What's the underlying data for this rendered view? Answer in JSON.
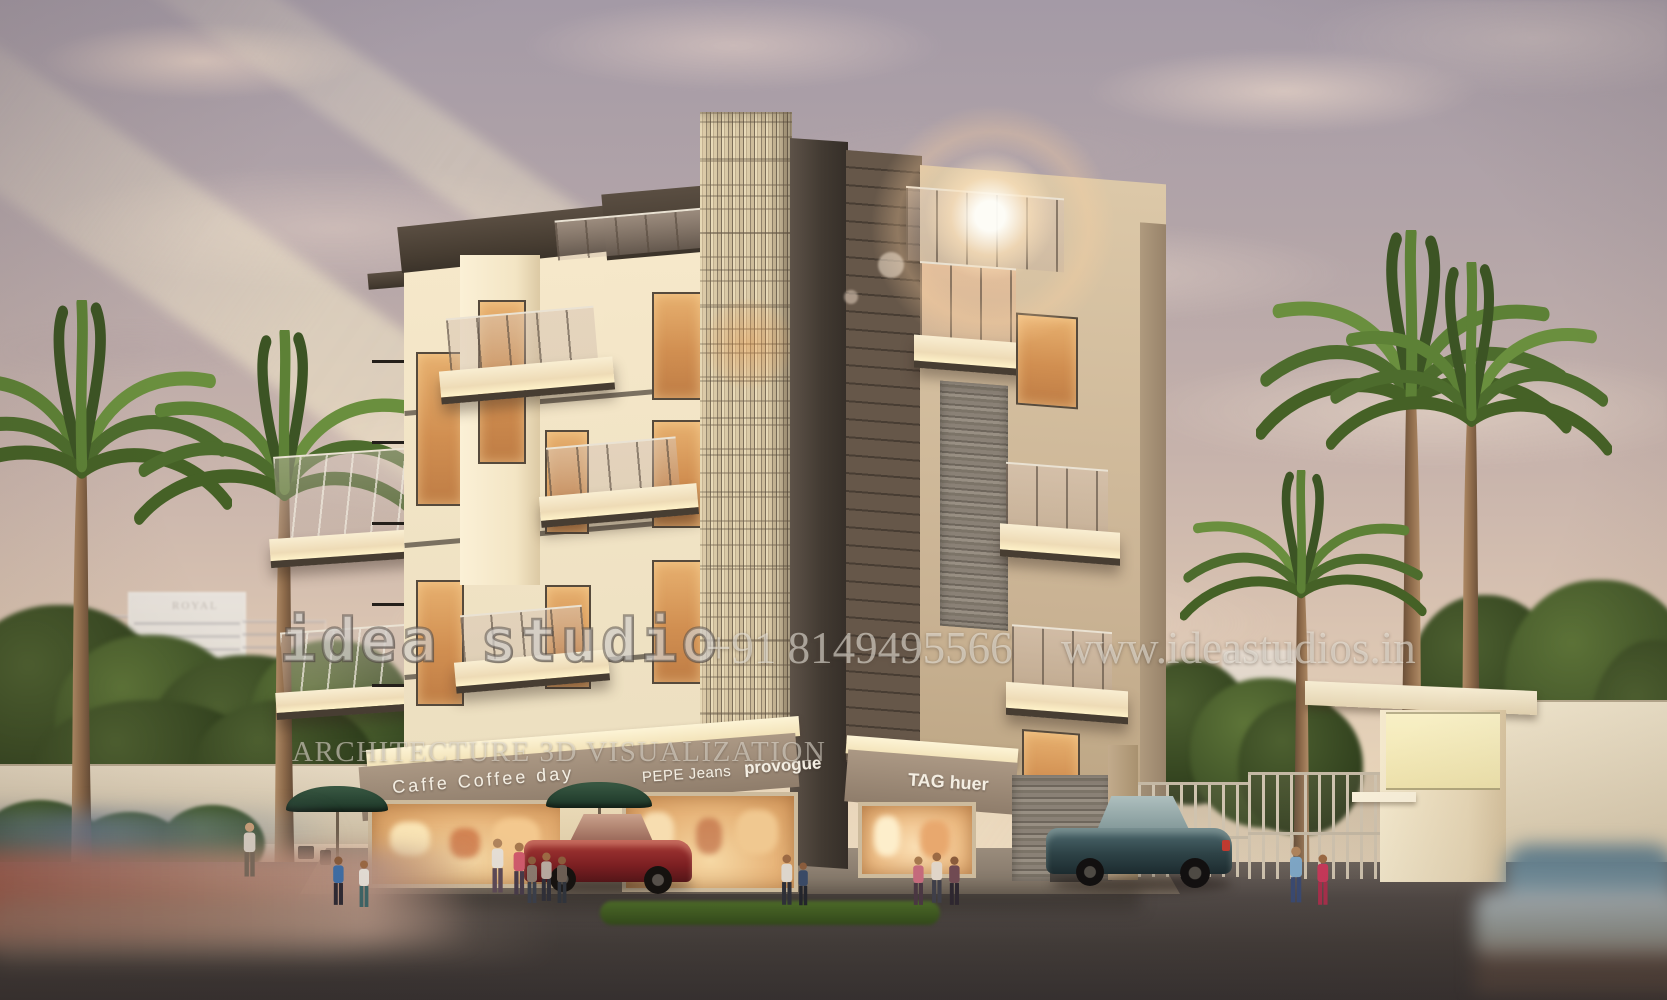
{
  "watermark": {
    "brand": "idea studio",
    "tagline": "ARCHITECTURE 3D VISUALIZATION",
    "phone": "+91 8149495566",
    "website": "www.ideastudios.in"
  },
  "shops": [
    {
      "name": "Caffe Coffee day"
    },
    {
      "name": "PEPE Jeans"
    },
    {
      "name": "provogue"
    },
    {
      "name": "TAG huer"
    }
  ],
  "background_sign": "ROYAL",
  "colors": {
    "sky_top": "#a49aa6",
    "sky_horizon": "#f1e1c6",
    "cloud": "#e2cbb8",
    "sun_flare": "#ffe4bc",
    "building_cream": "#f3e5c6",
    "building_dark_brown": "#473d32",
    "window_amber": "#d18f51",
    "slat_screen": "#dacaa7",
    "stone_cladding": "#8a8176",
    "fascia_taupe": "#a08d7a",
    "sign_text": "#f4eee2",
    "road": "#4f4845",
    "sidewalk": "#9a8c7c",
    "palm_green": "#4d6c2d",
    "tree_green": "#33431f",
    "red_car": "#8e2125",
    "teal_car": "#33474d",
    "umbrella_green": "#24402f"
  }
}
